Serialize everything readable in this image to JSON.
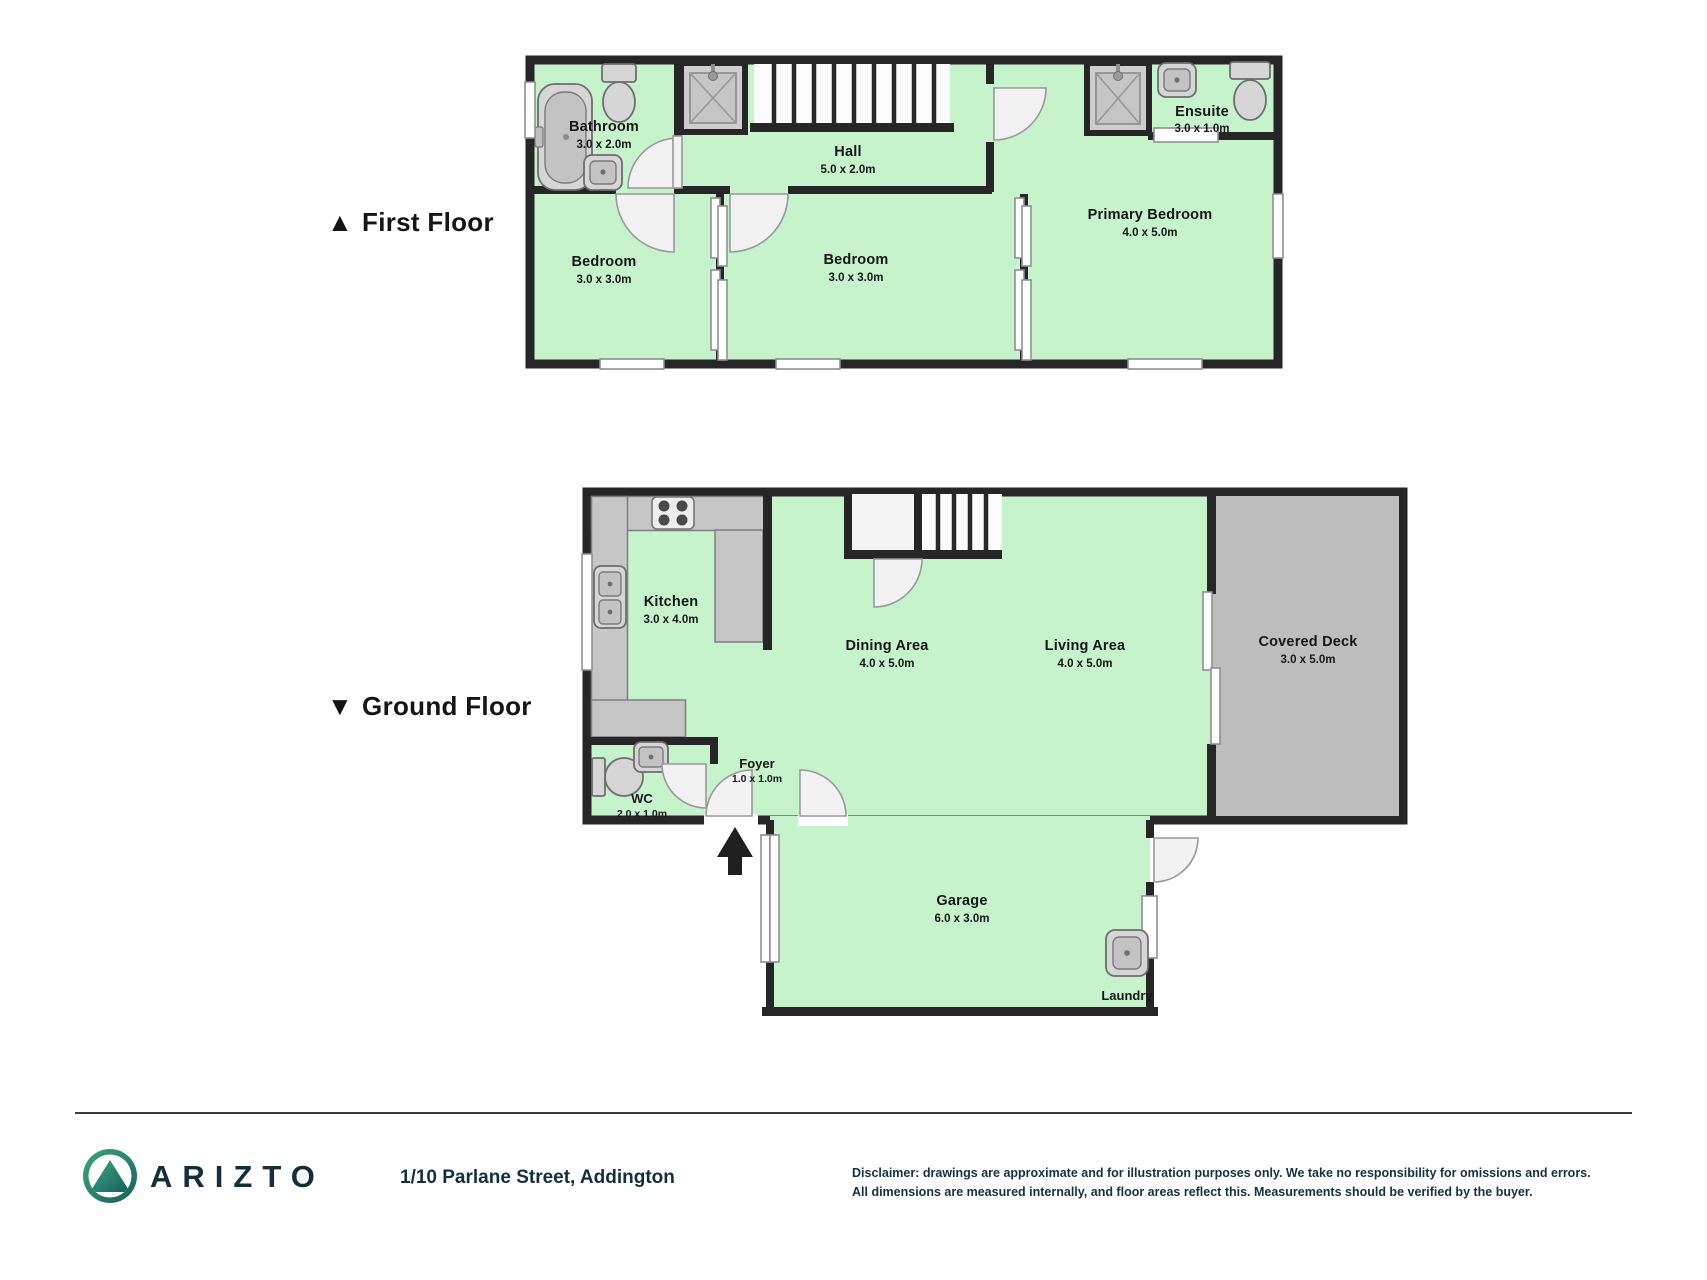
{
  "colors": {
    "wall": "#262626",
    "floor": "#c6f2cc",
    "deck": "#bdbdbd",
    "counter": "#c6c6c6",
    "fixture": "#d6d6d6",
    "door": "#f2f2f2",
    "brand_navy": "#132f3c",
    "logo_teal": "#3aa87c",
    "logo_teal_dark": "#1b5e5e",
    "text": "#171717"
  },
  "floor_plan": {
    "first_floor": {
      "marker": "▲",
      "label": "First Floor",
      "rooms": [
        {
          "name": "Bathroom",
          "dims": "3.0 x 2.0m"
        },
        {
          "name": "Hall",
          "dims": "5.0 x 2.0m"
        },
        {
          "name": "Ensuite",
          "dims": "3.0 x 1.0m"
        },
        {
          "name": "Bedroom",
          "dims": "3.0 x 3.0m"
        },
        {
          "name": "Bedroom",
          "dims": "3.0 x 3.0m"
        },
        {
          "name": "Primary Bedroom",
          "dims": "4.0 x 5.0m"
        }
      ]
    },
    "ground_floor": {
      "marker": "▼",
      "label": "Ground Floor",
      "rooms": [
        {
          "name": "Kitchen",
          "dims": "3.0 x 4.0m"
        },
        {
          "name": "Dining Area",
          "dims": "4.0 x 5.0m"
        },
        {
          "name": "Living Area",
          "dims": "4.0 x 5.0m"
        },
        {
          "name": "Covered Deck",
          "dims": "3.0 x 5.0m"
        },
        {
          "name": "WC",
          "dims": "2.0 x 1.0m"
        },
        {
          "name": "Foyer",
          "dims": "1.0 x 1.0m"
        },
        {
          "name": "Garage",
          "dims": "6.0 x 3.0m"
        },
        {
          "name": "Laundry",
          "dims": ""
        }
      ]
    }
  },
  "footer": {
    "brand": "ARIZTO",
    "address": "1/10 Parlane Street, Addington",
    "disclaimer_line1": "Disclaimer: drawings are approximate and for illustration purposes only. We take no responsibility for omissions and errors.",
    "disclaimer_line2": "All dimensions are measured internally, and floor areas reflect this. Measurements should be verified by the buyer."
  }
}
